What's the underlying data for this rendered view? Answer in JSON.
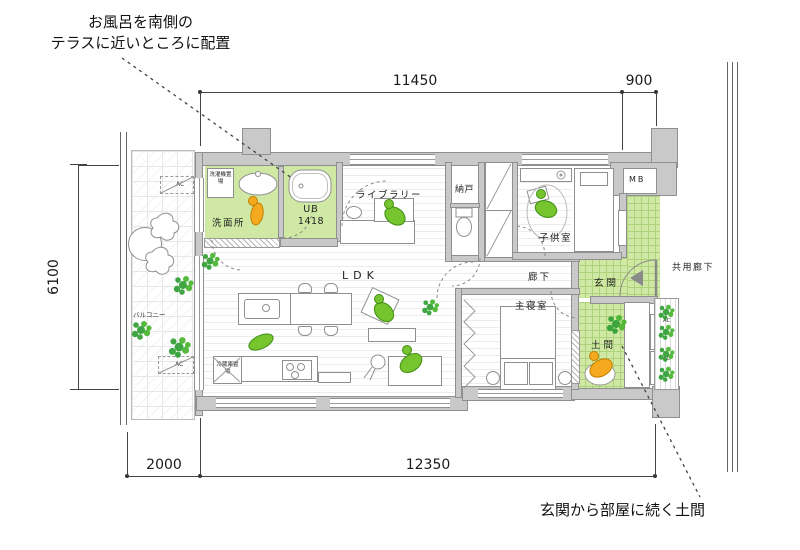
{
  "annotations": {
    "bath_note_line1": "お風呂を南側の",
    "bath_note_line2": "テラスに近いところに配置",
    "doma_note": "玄関から部屋に続く土間"
  },
  "dimensions": {
    "top_main": "11450",
    "top_right": "900",
    "left_side": "6100",
    "bottom_left": "2000",
    "bottom_main": "12350"
  },
  "rooms": {
    "balcony": "バルコニー",
    "washroom": "洗面所",
    "unit_bath_line1": "UB",
    "unit_bath_line2": "1418",
    "library": "ライブラリー",
    "storage": "納戸",
    "kids_room": "子供室",
    "meter_box": "MB",
    "shared_corridor": "共用廊下",
    "entrance": "玄関",
    "hallway": "廊下",
    "ldk": "LDK",
    "master_bedroom": "主寝室",
    "doma": "土間"
  },
  "equipment": {
    "washer_space": "洗濯機置場",
    "fridge_space": "冷蔵庫置場",
    "ac_unit": "AC"
  },
  "colors": {
    "room_green": "#cfe9a4",
    "grid_green_line": "#aed27c",
    "figure_green": "#76c52f",
    "figure_orange": "#f5a91f",
    "plant_green": "#2f9e33",
    "wall_gray": "#c9c9c9"
  }
}
